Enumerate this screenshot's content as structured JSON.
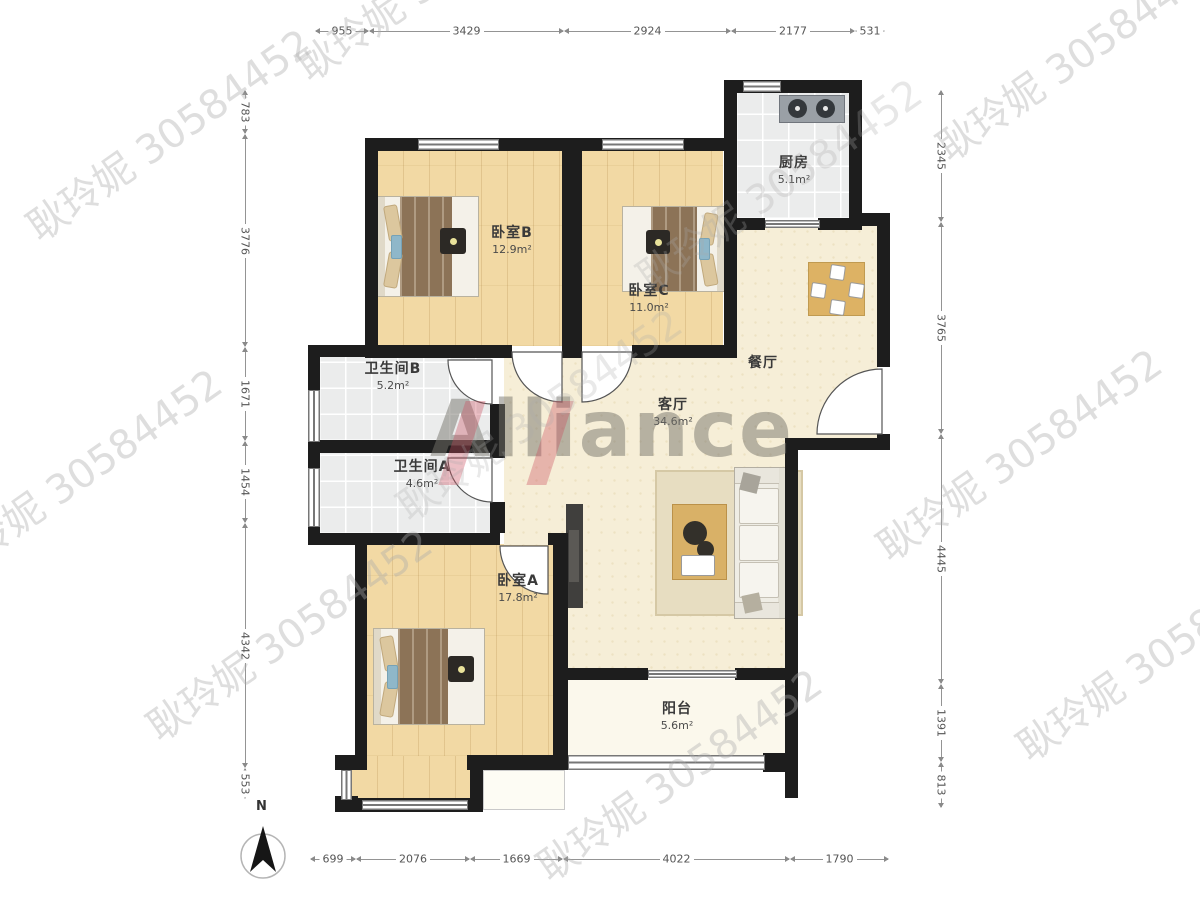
{
  "plan": {
    "compass_label": "N",
    "rooms": {
      "bedroom_b": {
        "name": "卧室B",
        "area": "12.9m²"
      },
      "bedroom_c": {
        "name": "卧室C",
        "area": "11.0m²"
      },
      "bedroom_a": {
        "name": "卧室A",
        "area": "17.8m²"
      },
      "kitchen": {
        "name": "厨房",
        "area": "5.1m²"
      },
      "dining": {
        "name": "餐厅"
      },
      "living": {
        "name": "客厅",
        "area": "34.6m²"
      },
      "bath_b": {
        "name": "卫生间B",
        "area": "5.2m²"
      },
      "bath_a": {
        "name": "卫生间A",
        "area": "4.6m²"
      },
      "balcony": {
        "name": "阳台",
        "area": "5.6m²"
      }
    },
    "dimensions_mm": {
      "top": [
        "955",
        "3429",
        "2924",
        "2177",
        "531"
      ],
      "bottom": [
        "699",
        "2076",
        "1669",
        "4022",
        "1790"
      ],
      "left": [
        "783",
        "3776",
        "1671",
        "1454",
        "4342",
        "553"
      ],
      "right": [
        "2345",
        "3765",
        "4445",
        "1391",
        "813"
      ]
    },
    "watermark": {
      "agent": "耿玲妮 30584452",
      "brand": "Alliance"
    },
    "colors": {
      "wall": "#1d1d1d",
      "wood_floor": "#f2d9a4",
      "tile_floor": "#ebecec",
      "living_floor": "#f6eed7",
      "brand_red": "#cb4e5e"
    }
  }
}
